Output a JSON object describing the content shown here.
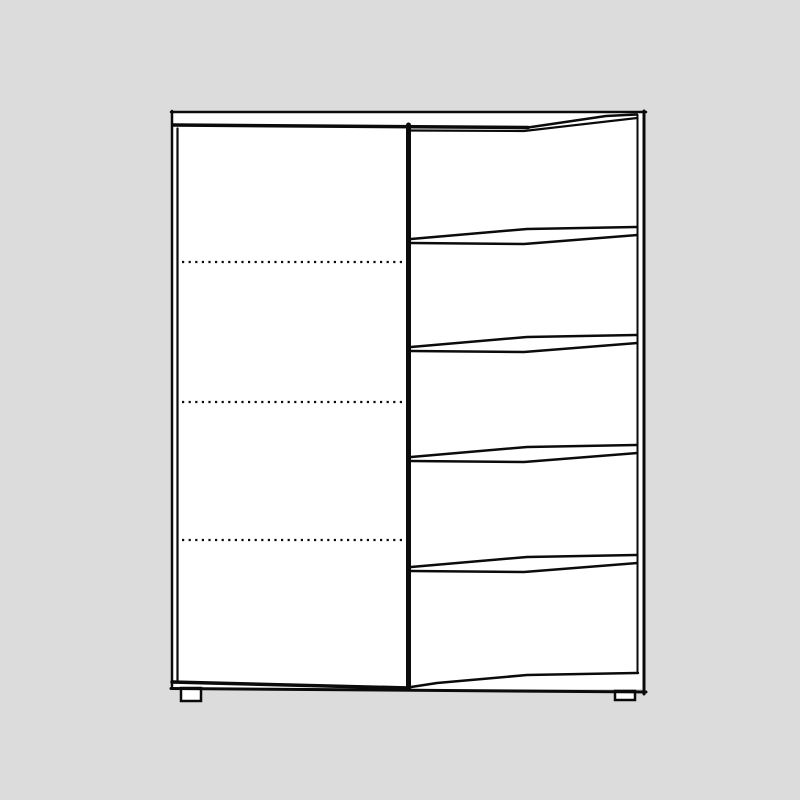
{
  "scene": {
    "background_color": "#dcdcdc",
    "line_color": "#0b0b0b",
    "surface_color": "#ffffff",
    "description": "Line drawing of a cabinet with a left hinged door showing three dotted shelf lines and a right-hand column of five handle-less drawers with slanted fronts, standing on a plinth with two small feet"
  },
  "cabinet": {
    "door_count": 1,
    "drawer_count": 5,
    "shelf_line_count": 3,
    "shelf_line_ys": [
      262,
      402,
      540
    ],
    "drawer_divider_ys": [
      234,
      342,
      452,
      562
    ],
    "drawer_left_x": 411,
    "drawer_right_x": 637,
    "shelf_left_x": 182,
    "shelf_right_x": 403
  }
}
